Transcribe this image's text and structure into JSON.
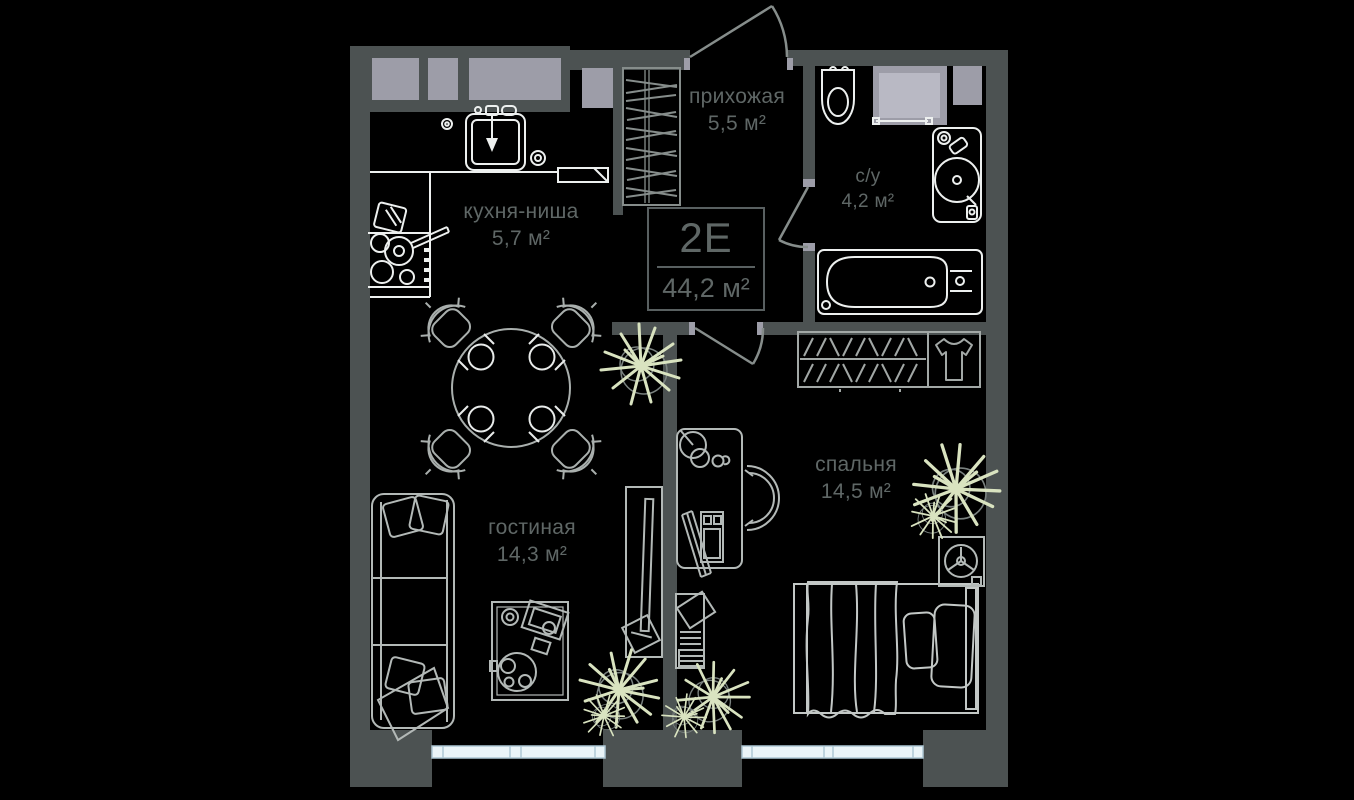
{
  "apartment": {
    "type": "2Е",
    "total_area": "44,2 м²"
  },
  "rooms": {
    "hallway": {
      "label": "прихожая",
      "area": "5,5 м²"
    },
    "bathroom": {
      "label": "с/у",
      "area": "4,2 м²"
    },
    "kitchen": {
      "label": "кухня-ниша",
      "area": "5,7 м²"
    },
    "living": {
      "label": "гостиная",
      "area": "14,3 м²"
    },
    "bedroom": {
      "label": "спальня",
      "area": "14,5 м²"
    }
  },
  "colors": {
    "background": "#000000",
    "wall": "#4c5252",
    "wall_block": "#9d9da8",
    "window_fill": "#eaf4f8",
    "window_frame": "#aec8d5",
    "fixture_line": "#edf0ef",
    "furniture_line": "#b3b9b7",
    "door_line": "#868d8b",
    "plant_leaf": "#d9e3c0",
    "label_text": "#5f6766"
  }
}
